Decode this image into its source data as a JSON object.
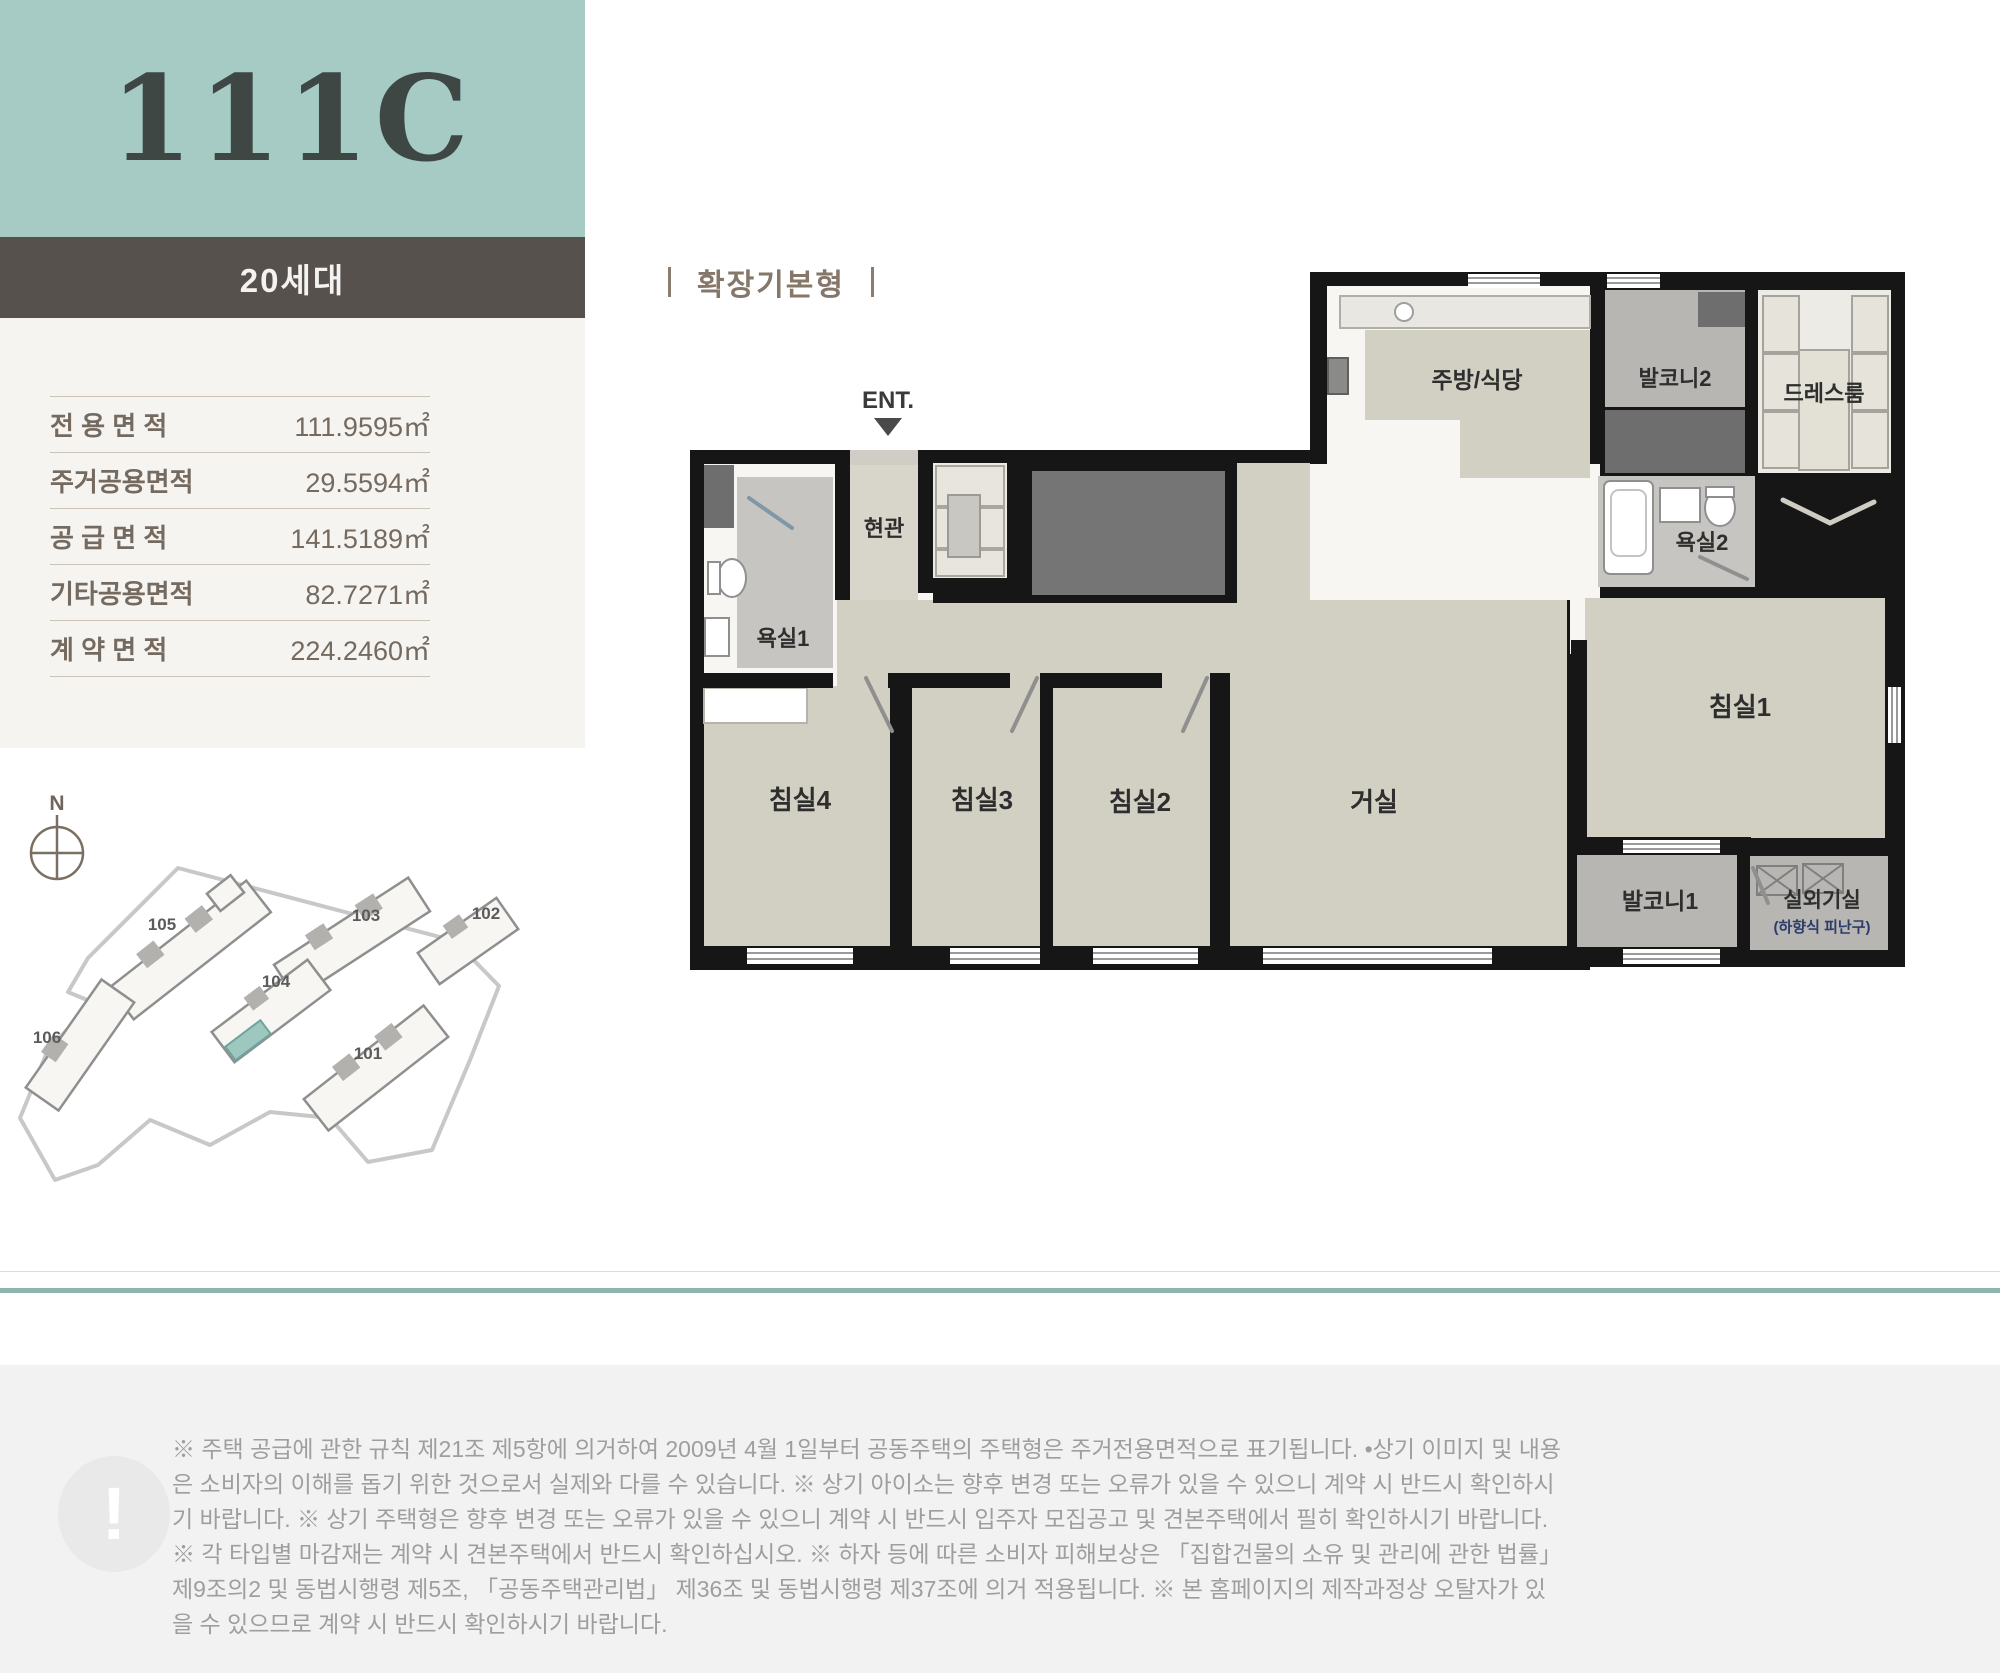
{
  "unit_header": {
    "type_code": "111C",
    "households": "20세대"
  },
  "area_table": {
    "rows": [
      {
        "label": "전 용 면 적",
        "value": "111.9595㎡"
      },
      {
        "label": "주거공용면적",
        "value": "29.5594㎡"
      },
      {
        "label": "공 급 면 적",
        "value": "141.5189㎡"
      },
      {
        "label": "기타공용면적",
        "value": "82.7271㎡"
      },
      {
        "label": "계 약 면 적",
        "value": "224.2460㎡"
      }
    ]
  },
  "floor_plan": {
    "title": "확장기본형",
    "entrance_label": "ENT.",
    "rooms": {
      "kitchen": "주방/식당",
      "balcony2": "발코니2",
      "dressroom": "드레스룸",
      "bath2": "욕실2",
      "bedroom1": "침실1",
      "entry": "현관",
      "bath1": "욕실1",
      "bedroom4": "침실4",
      "bedroom3": "침실3",
      "bedroom2": "침실2",
      "living": "거실",
      "balcony1": "발코니1",
      "outdoor_unit": "실외기실",
      "outdoor_unit_sub": "(하향식 피난구)"
    }
  },
  "site_plan": {
    "compass": "N",
    "highlight_building": "104",
    "highlight_color": "#9ec7c0",
    "buildings": [
      {
        "no": "105"
      },
      {
        "no": "103"
      },
      {
        "no": "102"
      },
      {
        "no": "104"
      },
      {
        "no": "101"
      },
      {
        "no": "106"
      }
    ]
  },
  "disclaimer": {
    "icon": "!",
    "text": "※ 주택 공급에 관한 규칙 제21조 제5항에 의거하여 2009년 4월 1일부터 공동주택의 주택형은 주거전용면적으로 표기됩니다. •상기 이미지 및 내용은 소비자의 이해를 돕기 위한 것으로서 실제와 다를 수 있습니다. ※ 상기 아이소는 향후 변경 또는 오류가 있을 수 있으니 계약 시 반드시 확인하시기 바랍니다. ※ 상기 주택형은 향후 변경 또는 오류가 있을 수 있으니 계약 시 반드시 입주자 모집공고 및 견본주택에서 필히 확인하시기 바랍니다. ※ 각 타입별 마감재는 계약 시 견본주택에서 반드시 확인하십시오. ※ 하자 등에 따른 소비자 피해보상은 「집합건물의 소유 및 관리에 관한 법률」 제9조의2 및 동법시행령 제5조, 「공동주택관리법」 제36조 및 동법시행령 제37조에 의거 적용됩니다. ※ 본 홈페이지의 제작과정상 오탈자가 있을 수 있으므로 계약 시 반드시 확인하시기 바랍니다."
  },
  "colors": {
    "accent_teal": "#a6cbc5",
    "header_dark": "#57514e",
    "divider_teal": "#8fb5b1",
    "plan_wall": "#161616",
    "plan_room_beige": "#d2cfc3",
    "plan_balcony_gray": "#b7b6b2",
    "plan_core_gray": "#757575"
  }
}
